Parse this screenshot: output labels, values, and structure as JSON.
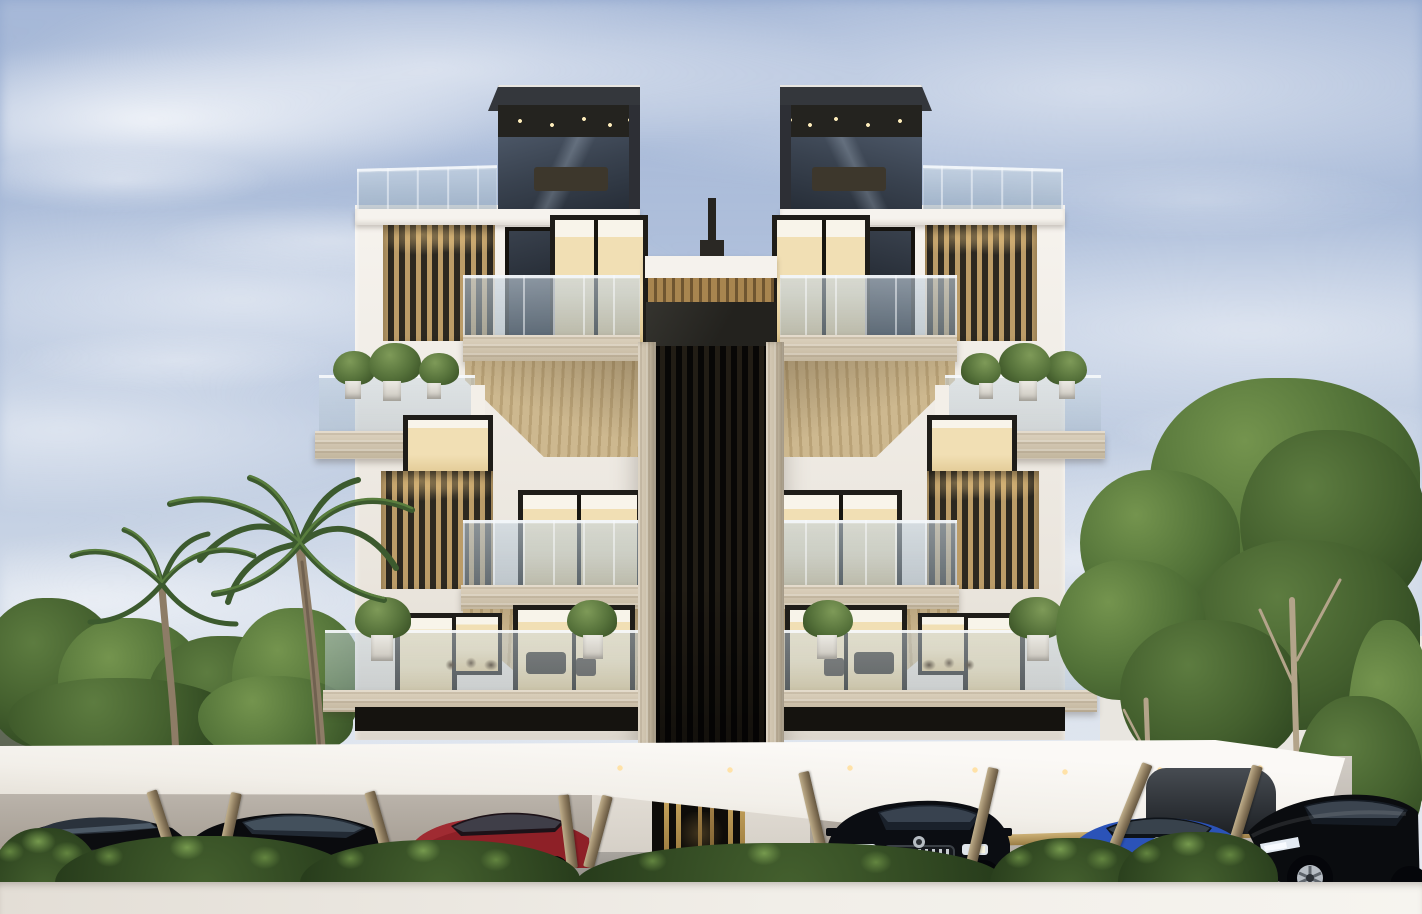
{
  "meta": {
    "kind": "3d-architectural-rendering",
    "title": "Modern residential apartment building exterior rendering"
  },
  "palette": {
    "sky-top": "#93a9cf",
    "sky-mid": "#aebfdb",
    "sky-low": "#c6d2e4",
    "cloud": "#f2f4f7",
    "hill-far": "#8e97a3",
    "hill-near": "#6d7663",
    "tree-dark": "#3c5729",
    "tree-mid": "#527238",
    "tree-light": "#74944e",
    "palm-green": "#3c5a2e",
    "palm-light": "#597e3e",
    "palm-trunk": "#8d7c66",
    "facade-white": "#f5f2ed",
    "facade-shade": "#e4dfd6",
    "roof-dark": "#34373c",
    "ceiling-dark": "#24231f",
    "glass-blue": "#a9bccb",
    "glass-dark": "#39424f",
    "louver-wood": "#bb9c68",
    "louver-gap": "#2c2820",
    "travertine": "#d8cdb9",
    "wood-soffit": "#c8b38c",
    "core-dark": "#17150f",
    "gold": "#a98a52",
    "canopy-white": "#f7f5f2",
    "shadow-wall": "#a9a49d",
    "pavement": "#98948e",
    "car-black": "#0b0d11",
    "car-red": "#8e2027",
    "car-blue": "#2b53b8",
    "taillight-red": "#d8362a",
    "headlight-warm": "#e8dfc2",
    "bush-green": "#44602e",
    "bush-light": "#638540",
    "wall-white": "#efece6",
    "window-warm": "#f1dfb4",
    "frame-dark": "#1f1d19"
  },
  "scene": {
    "labels": {
      "stage": "Photorealistic rendering of a modern 4-storey twin-tower apartment building with rooftop terraces, wood louver screens, glass balconies, a carport canopy with parked cars, palm trees and landscaping",
      "sky": "blue sky with wispy white clouds",
      "building": "white twin-tower residential building with central dark entrance core",
      "penthouse": "dark rooftop penthouse box with recessed ceiling lights",
      "louvers": "vertical timber louver screens on tower flanks",
      "balconies": "glass-railed balconies with travertine slabs and timber soffits",
      "core": "dark vertical-slat central core with brass-framed entrance",
      "canopy": "white carport canopy with brass fascia and angled bronze struts",
      "vegetation": "palm trees, leafy trees, hedges and distant hills"
    },
    "counts": {
      "towers": 2,
      "visible-floors": 4,
      "palm-trees": 2,
      "canopy-struts": 9,
      "cars": 7
    },
    "cars": [
      {
        "position": "far-left",
        "view": "side, rear at left",
        "color": "black"
      },
      {
        "position": "left",
        "view": "three-quarter front",
        "color": "black"
      },
      {
        "position": "center-left",
        "view": "three-quarter rear",
        "color": "dark red"
      },
      {
        "position": "center-right",
        "view": "front with chrome slat grille",
        "color": "black"
      },
      {
        "position": "behind-right",
        "view": "partial glimpse",
        "color": "dark grey"
      },
      {
        "position": "right",
        "view": "rear with twin red taillights",
        "color": "blue"
      },
      {
        "position": "far-right",
        "view": "three-quarter front with alloy wheel",
        "color": "black"
      }
    ]
  }
}
